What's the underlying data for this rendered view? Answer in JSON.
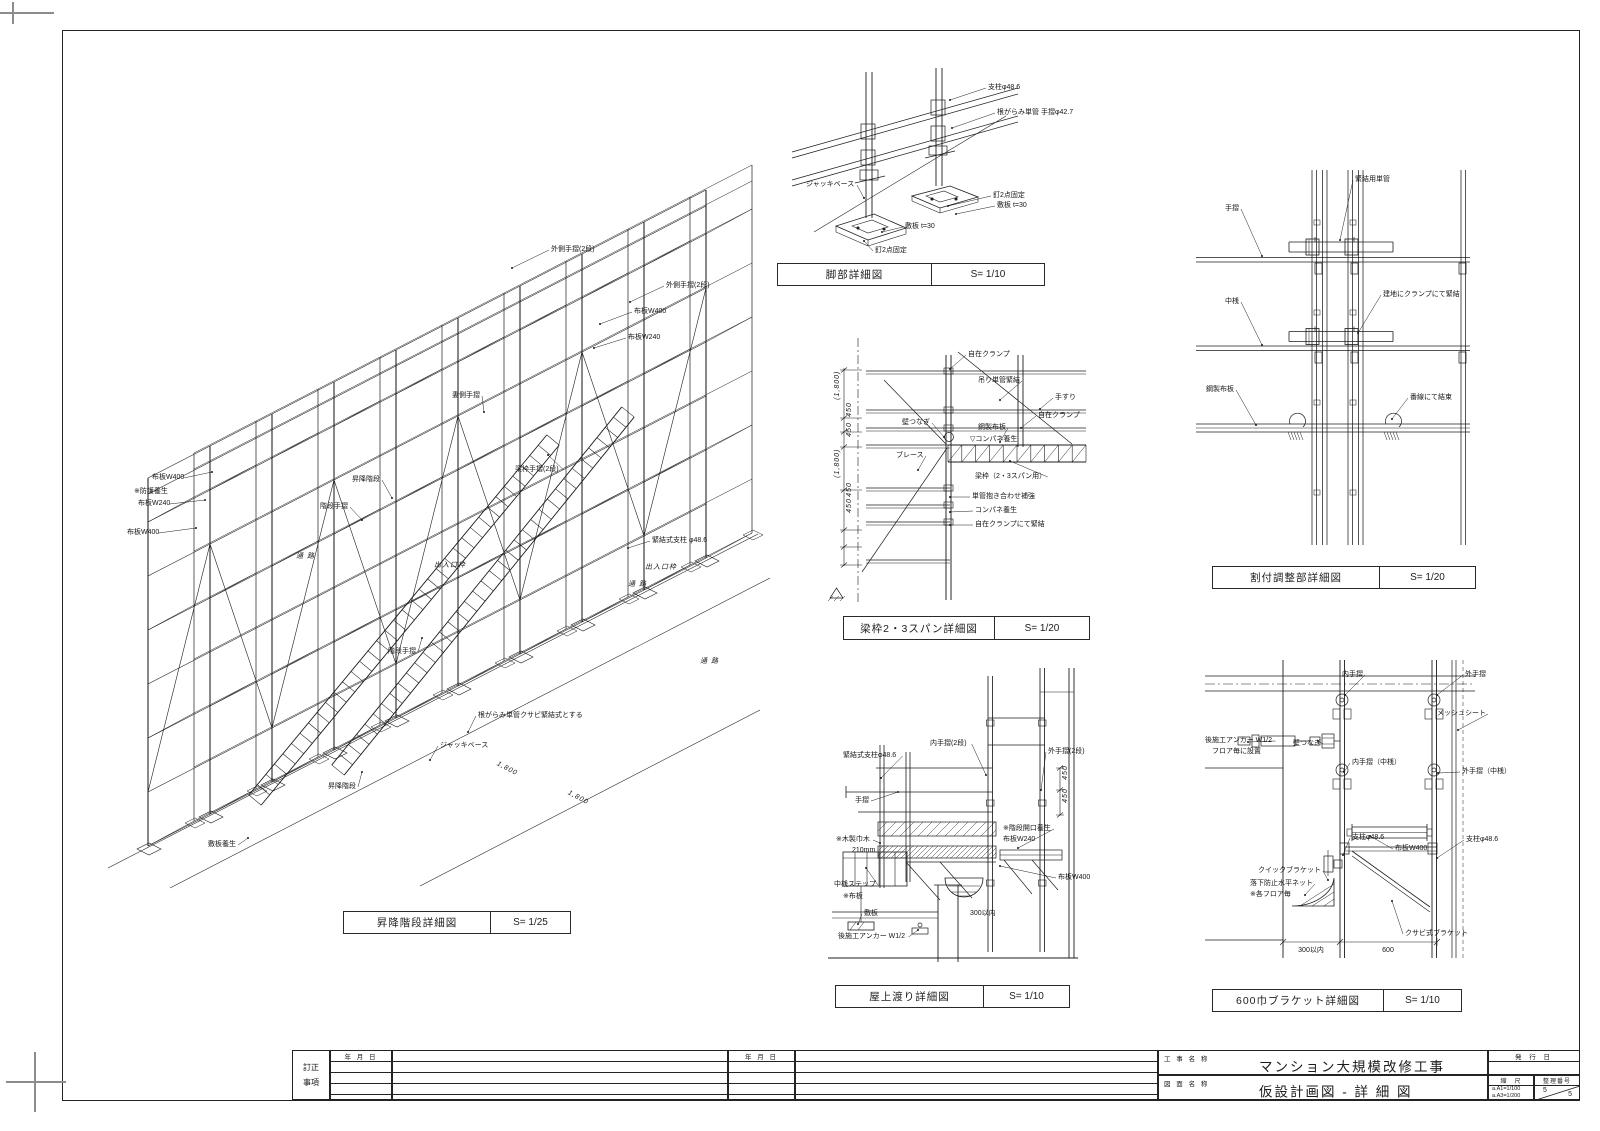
{
  "document": {
    "type": "construction-detail-sheet",
    "language": "ja"
  },
  "views": [
    {
      "id": "stairs-iso",
      "title": "昇降階段詳細図",
      "scale": "S= 1/25",
      "box": {
        "x": 343,
        "y": 911,
        "w": 226,
        "h": 21,
        "split": 146
      },
      "labels": [
        {
          "t": "外側手摺(2段)",
          "x": 551,
          "y": 250,
          "tx": 512,
          "ty": 268
        },
        {
          "t": "外側手摺(2段)",
          "x": 666,
          "y": 286,
          "tx": 630,
          "ty": 302
        },
        {
          "t": "布板W400",
          "x": 634,
          "y": 312,
          "tx": 600,
          "ty": 324
        },
        {
          "t": "布板W240",
          "x": 628,
          "y": 338,
          "tx": 594,
          "ty": 348
        },
        {
          "t": "妻側手摺",
          "x": 452,
          "y": 396,
          "tx": 484,
          "ty": 412
        },
        {
          "t": "梁枠手摺(2段)",
          "x": 515,
          "y": 470,
          "tx": 548,
          "ty": 455
        },
        {
          "t": "布板W400",
          "x": 152,
          "y": 478,
          "tx": 212,
          "ty": 472
        },
        {
          "t": "※防護養生",
          "x": 134,
          "y": 492
        },
        {
          "t": "布板W240",
          "x": 138,
          "y": 504,
          "tx": 205,
          "ty": 500
        },
        {
          "t": "布板W400",
          "x": 127,
          "y": 533,
          "tx": 196,
          "ty": 528
        },
        {
          "t": "昇降階段",
          "x": 352,
          "y": 480,
          "tx": 392,
          "ty": 498
        },
        {
          "t": "階段手摺",
          "x": 320,
          "y": 507,
          "tx": 362,
          "ty": 520
        },
        {
          "t": "緊結式支柱 φ48.6",
          "x": 652,
          "y": 541,
          "tx": 628,
          "ty": 548
        },
        {
          "t": "出入口枠",
          "x": 434,
          "y": 566,
          "i": 1
        },
        {
          "t": "出入口枠",
          "x": 645,
          "y": 568,
          "i": 1
        },
        {
          "t": "通 路",
          "x": 296,
          "y": 557,
          "i": 1
        },
        {
          "t": "通 路",
          "x": 628,
          "y": 585,
          "i": 1
        },
        {
          "t": "通 路",
          "x": 700,
          "y": 662,
          "i": 1
        },
        {
          "t": "階段手摺",
          "x": 388,
          "y": 652,
          "tx": 422,
          "ty": 638
        },
        {
          "t": "根がらみ単管クサビ緊結式とする",
          "x": 478,
          "y": 716,
          "tx": 468,
          "ty": 732
        },
        {
          "t": "ジャッキベース",
          "x": 440,
          "y": 746,
          "tx": 430,
          "ty": 760
        },
        {
          "t": "昇降階段",
          "x": 328,
          "y": 787,
          "tx": 362,
          "ty": 772
        },
        {
          "t": "敷板養生",
          "x": 208,
          "y": 845,
          "tx": 248,
          "ty": 838
        },
        {
          "t": "1,800",
          "x": 497,
          "y": 764,
          "i": 1,
          "r": 28
        },
        {
          "t": "1,800",
          "x": 568,
          "y": 793,
          "i": 1,
          "r": 28
        }
      ]
    },
    {
      "id": "foot-detail",
      "title": "脚部詳細図",
      "scale": "S= 1/10",
      "box": {
        "x": 777,
        "y": 263,
        "w": 266,
        "h": 21,
        "split": 153
      },
      "labels": [
        {
          "t": "支柱φ48.6",
          "x": 988,
          "y": 88,
          "tx": 950,
          "ty": 100
        },
        {
          "t": "根がらみ単管  手摺φ42.7",
          "x": 997,
          "y": 113,
          "tx": 952,
          "ty": 128
        },
        {
          "t": "ジャッキベース",
          "x": 806,
          "y": 185,
          "tx": 864,
          "ty": 198
        },
        {
          "t": "釘2点固定",
          "x": 993,
          "y": 196,
          "tx": 948,
          "ty": 206
        },
        {
          "t": "敷板 t=30",
          "x": 997,
          "y": 206,
          "tx": 956,
          "ty": 214
        },
        {
          "t": "敷板 t=30",
          "x": 905,
          "y": 227,
          "tx": 882,
          "ty": 232
        },
        {
          "t": "釘2点固定",
          "x": 875,
          "y": 251,
          "tx": 864,
          "ty": 241
        }
      ]
    },
    {
      "id": "beam-frame-detail",
      "title": "梁枠2・3スパン詳細図",
      "scale": "S= 1/20",
      "box": {
        "x": 843,
        "y": 616,
        "w": 245,
        "h": 22,
        "split": 150
      },
      "labels": [
        {
          "t": "自在クランプ",
          "x": 968,
          "y": 355,
          "tx": 950,
          "ty": 369
        },
        {
          "t": "吊り単管緊結",
          "x": 978,
          "y": 381,
          "tx": 1000,
          "ty": 400
        },
        {
          "t": "手すり",
          "x": 1055,
          "y": 398,
          "tx": 1040,
          "ty": 409
        },
        {
          "t": "自在クランプ",
          "x": 1038,
          "y": 416,
          "tx": 1021,
          "ty": 428
        },
        {
          "t": "壁つなぎ",
          "x": 902,
          "y": 423,
          "tx": 944,
          "ty": 437
        },
        {
          "t": "鋼製布板",
          "x": 978,
          "y": 428,
          "tx": 1000,
          "ty": 442
        },
        {
          "t": "▽コンパネ養生",
          "x": 970,
          "y": 440
        },
        {
          "t": "ブレース",
          "x": 896,
          "y": 456,
          "tx": 918,
          "ty": 470
        },
        {
          "t": "梁枠（2・3スパン用）",
          "x": 975,
          "y": 477,
          "tx": 1010,
          "ty": 461
        },
        {
          "t": "単管抱き合わせ補強",
          "x": 972,
          "y": 497,
          "tx": 950,
          "ty": 497
        },
        {
          "t": "コンパネ養生",
          "x": 975,
          "y": 511,
          "tx": 950,
          "ty": 512
        },
        {
          "t": "自在クランプにて緊結",
          "x": 975,
          "y": 525,
          "tx": 950,
          "ty": 525
        },
        {
          "t": "(1,800)",
          "x": 838,
          "y": 400,
          "r": -90,
          "i": 1
        },
        {
          "t": "450",
          "x": 850,
          "y": 417,
          "r": -90,
          "i": 1
        },
        {
          "t": "450",
          "x": 850,
          "y": 437,
          "r": -90,
          "i": 1
        },
        {
          "t": "(1,800)",
          "x": 838,
          "y": 478,
          "r": -90,
          "i": 1
        },
        {
          "t": "450",
          "x": 850,
          "y": 497,
          "r": -90,
          "i": 1
        },
        {
          "t": "450",
          "x": 850,
          "y": 513,
          "r": -90,
          "i": 1
        }
      ]
    },
    {
      "id": "layout-adjust-detail",
      "title": "割付調整部詳細図",
      "scale": "S= 1/20",
      "box": {
        "x": 1212,
        "y": 566,
        "w": 262,
        "h": 21,
        "split": 166
      },
      "labels": [
        {
          "t": "緊結用単管",
          "x": 1355,
          "y": 180,
          "tx": 1340,
          "ty": 240
        },
        {
          "t": "手摺",
          "x": 1225,
          "y": 209,
          "tx": 1262,
          "ty": 256
        },
        {
          "t": "建地にクランプにて緊結",
          "x": 1383,
          "y": 295,
          "tx": 1358,
          "ty": 333
        },
        {
          "t": "中桟",
          "x": 1225,
          "y": 302,
          "tx": 1262,
          "ty": 345
        },
        {
          "t": "鋼製布板",
          "x": 1206,
          "y": 390,
          "tx": 1256,
          "ty": 425
        },
        {
          "t": "番線にて結束",
          "x": 1410,
          "y": 398,
          "tx": 1392,
          "ty": 419
        }
      ]
    },
    {
      "id": "rooftop-cross-detail",
      "title": "屋上渡り詳細図",
      "scale": "S= 1/10",
      "box": {
        "x": 835,
        "y": 985,
        "w": 233,
        "h": 21,
        "split": 147
      },
      "labels": [
        {
          "t": "内手摺(2段)",
          "x": 930,
          "y": 744,
          "tx": 986,
          "ty": 775
        },
        {
          "t": "外手摺(2段)",
          "x": 1048,
          "y": 752,
          "tx": 1041,
          "ty": 790
        },
        {
          "t": "緊結式支柱φ48.6",
          "x": 843,
          "y": 756,
          "tx": 881,
          "ty": 778
        },
        {
          "t": "手摺",
          "x": 855,
          "y": 801,
          "tx": 898,
          "ty": 792
        },
        {
          "t": "※木製巾木",
          "x": 836,
          "y": 840,
          "tx": 880,
          "ty": 843
        },
        {
          "t": "210mm",
          "x": 852,
          "y": 851
        },
        {
          "t": "※階段開口養生",
          "x": 1003,
          "y": 829,
          "tx": 1018,
          "ty": 848
        },
        {
          "t": "布板W240",
          "x": 1003,
          "y": 840
        },
        {
          "t": "布板W400",
          "x": 1058,
          "y": 878,
          "tx": 1000,
          "ty": 866
        },
        {
          "t": "中桟ステップ",
          "x": 834,
          "y": 885,
          "tx": 866,
          "ty": 868
        },
        {
          "t": "※布板",
          "x": 843,
          "y": 897
        },
        {
          "t": "敷板",
          "x": 864,
          "y": 914,
          "tx": 858,
          "ty": 924
        },
        {
          "t": "後施工アンカー W1/2",
          "x": 838,
          "y": 937,
          "tx": 918,
          "ty": 930
        },
        {
          "t": "300以内",
          "x": 970,
          "y": 914
        },
        {
          "t": "450",
          "x": 1066,
          "y": 780,
          "r": -90,
          "i": 1
        },
        {
          "t": "450",
          "x": 1066,
          "y": 803,
          "r": -90,
          "i": 1
        }
      ]
    },
    {
      "id": "bracket-600-detail",
      "title": "600巾ブラケット詳細図",
      "scale": "S= 1/10",
      "box": {
        "x": 1212,
        "y": 989,
        "w": 248,
        "h": 21,
        "split": 170
      },
      "labels": [
        {
          "t": "内手摺",
          "x": 1342,
          "y": 675,
          "tx": 1345,
          "ty": 695
        },
        {
          "t": "外手摺",
          "x": 1465,
          "y": 675,
          "tx": 1437,
          "ty": 695
        },
        {
          "t": "後施工アンカー W1/2",
          "x": 1205,
          "y": 741,
          "tx": 1248,
          "ty": 742
        },
        {
          "t": "フロア毎に設置",
          "x": 1212,
          "y": 752
        },
        {
          "t": "壁つなぎ",
          "x": 1293,
          "y": 744,
          "tx": 1318,
          "ty": 741
        },
        {
          "t": "メッシュシート",
          "x": 1437,
          "y": 714,
          "tx": 1458,
          "ty": 730
        },
        {
          "t": "内手摺（中桟）",
          "x": 1352,
          "y": 763,
          "tx": 1344,
          "ty": 772
        },
        {
          "t": "外手摺（中桟）",
          "x": 1462,
          "y": 772,
          "tx": 1438,
          "ty": 773
        },
        {
          "t": "支柱φ48.6",
          "x": 1352,
          "y": 838,
          "tx": 1343,
          "ty": 855
        },
        {
          "t": "支柱φ48.6",
          "x": 1466,
          "y": 840,
          "tx": 1437,
          "ty": 858
        },
        {
          "t": "布板W400",
          "x": 1395,
          "y": 849,
          "tx": 1370,
          "ty": 836
        },
        {
          "t": "クイックブラケット",
          "x": 1258,
          "y": 871,
          "tx": 1328,
          "ty": 880
        },
        {
          "t": "落下防止水平ネット",
          "x": 1250,
          "y": 884,
          "tx": 1305,
          "ty": 895
        },
        {
          "t": "※各フロア毎",
          "x": 1250,
          "y": 895
        },
        {
          "t": "クサビ式ブラケット",
          "x": 1405,
          "y": 934,
          "tx": 1392,
          "ty": 901
        },
        {
          "t": "300以内",
          "x": 1311,
          "y": 951,
          "a": "m"
        },
        {
          "t": "600",
          "x": 1388,
          "y": 951,
          "a": "m"
        }
      ]
    }
  ],
  "title_block": {
    "revision_label_top": "訂正",
    "revision_label_bottom": "事項",
    "date_header": "年 月 日",
    "project_label": "工 事 名 称",
    "project_name": "マンション大規模改修工事",
    "drawing_label": "図 面 名 称",
    "drawing_name": "仮設計画図 - 詳 細 図",
    "issue_label": "発 行 日",
    "scale_label": "縮　尺",
    "scale_line1": "a.A1=1/100",
    "scale_line2": "a.A3=1/200",
    "serial_label": "整理番号",
    "serial_top": "5",
    "serial_bottom": "5"
  }
}
